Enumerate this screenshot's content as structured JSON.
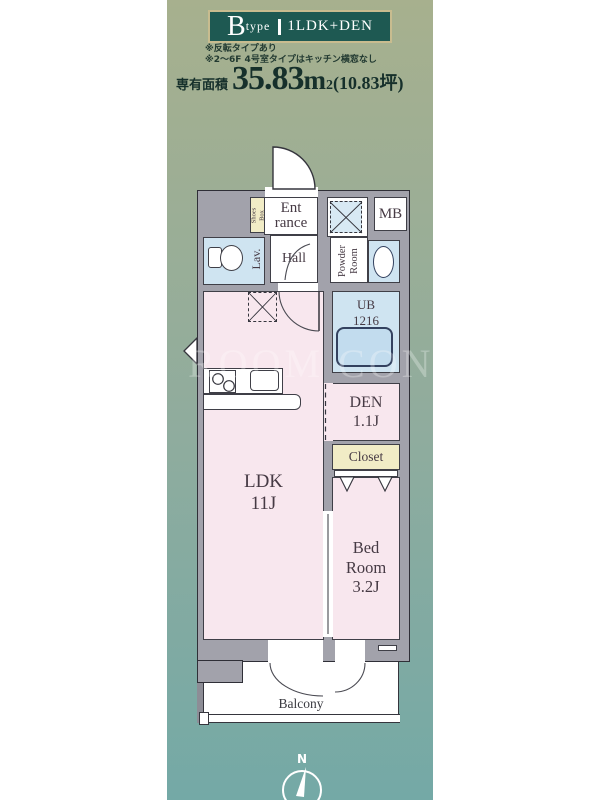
{
  "header": {
    "type_letter": "B",
    "type_word": "type",
    "separator": "|",
    "layout": "1LDK+DEN"
  },
  "notes": {
    "line1": "※反転タイプあり",
    "line2": "※2〜6F 4号室タイプはキッチン横窓なし"
  },
  "area": {
    "label": "専有面積",
    "value": "35.83",
    "unit": "m",
    "unit_sup": "2",
    "tsubo": "(10.83坪)"
  },
  "plan": {
    "entrance_l1": "Ent",
    "entrance_l2": "rance",
    "shoes_l1": "Shoes",
    "shoes_l2": "Box",
    "mb": "MB",
    "lav": "Lav.",
    "hall": "Hall",
    "powder_l1": "Powder",
    "powder_l2": "Room",
    "ub_l1": "UB",
    "ub_l2": "1216",
    "den_l1": "DEN",
    "den_l2": "1.1J",
    "closet": "Closet",
    "ldk_l1": "LDK",
    "ldk_l2": "11J",
    "bed_l1": "Bed",
    "bed_l2": "Room",
    "bed_l3": "3.2J",
    "balcony": "Balcony"
  },
  "compass": {
    "north": "N"
  },
  "watermark": "ROOM CONC",
  "colors": {
    "gradient_top": "#a7b08e",
    "gradient_bottom": "#74a9a6",
    "header_bg": "#1e5952",
    "header_border": "#c8bc8f",
    "wall_fill": "#a2a2ab",
    "wall_line": "#35353d",
    "room_pink": "#f8e7ee",
    "room_blue": "#cfe4f1",
    "room_beige": "#f1ecc6",
    "tub_blue": "#c2dcee",
    "text_dark": "#16302b",
    "label_color": "#463a44"
  }
}
